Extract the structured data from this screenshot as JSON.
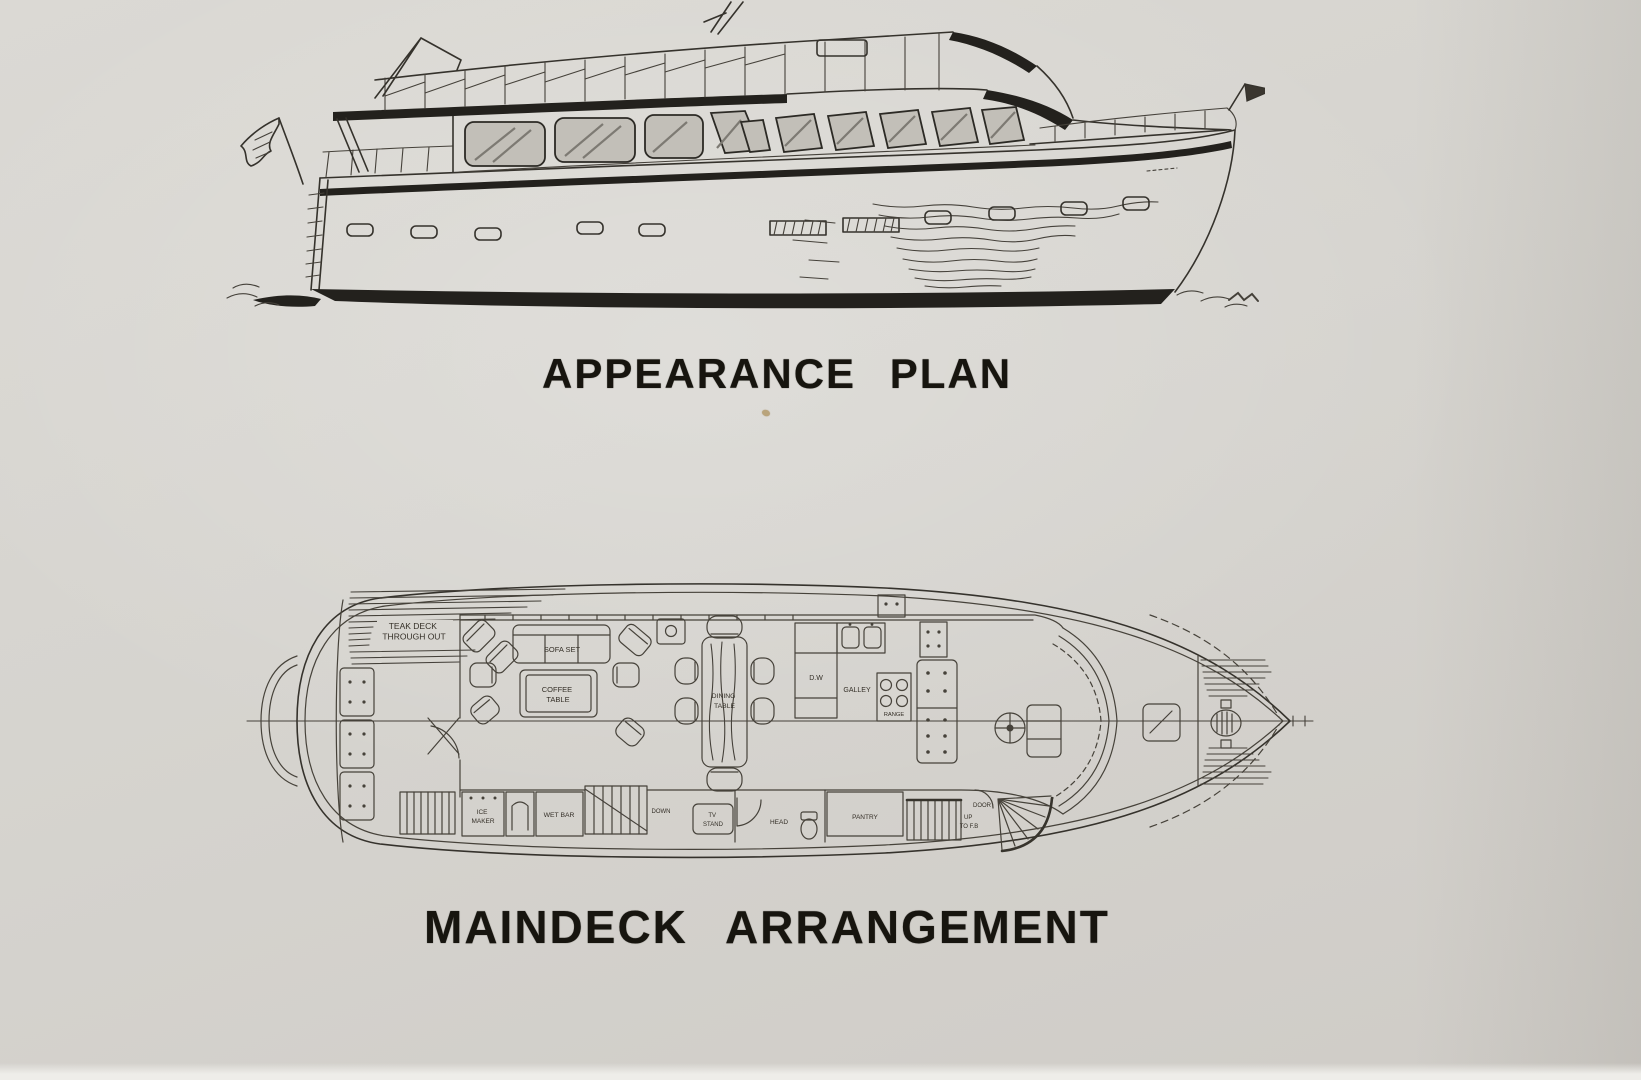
{
  "document": {
    "kind": "scanned yacht brochure page",
    "paper_color": "#d6d4cf",
    "ink_color": "#35322c"
  },
  "titles": {
    "appearance_plan": "APPEARANCE PLAN",
    "maindeck_arrangement": "MAINDECK ARRANGEMENT"
  },
  "appearance_plan": {
    "drawing": "motor yacht side-profile line drawing",
    "feature_icons": [
      "stern-flag-icon",
      "transom-ladder-icon",
      "davit-mast-icon",
      "antenna-mast-icon",
      "flybridge-railing-icon",
      "salon-windows-icon",
      "pilothouse-windows-icon",
      "bow-railing-icon",
      "bow-flag-icon",
      "porthole-icon",
      "engine-vent-icon",
      "waterline-ripples-icon"
    ]
  },
  "deck_plan": {
    "drawing": "maindeck top-view arrangement plan",
    "labels": {
      "teak_deck_line1": "TEAK DECK",
      "teak_deck_line2": "THROUGH OUT",
      "sofa_set": "SOFA SET",
      "coffee_table_line1": "COFFEE",
      "coffee_table_line2": "TABLE",
      "dining_table_line1": "DINING",
      "dining_table_line2": "TABLE",
      "dishwasher": "D.W",
      "galley": "GALLEY",
      "range": "RANGE",
      "ice_maker_line1": "ICE",
      "ice_maker_line2": "MAKER",
      "wet_bar": "WET BAR",
      "stairs_down": "DOWN",
      "tv_stand_line1": "TV",
      "tv_stand_line2": "STAND",
      "head": "HEAD",
      "pantry": "PANTRY",
      "door": "DOOR",
      "stairs_up_line1": "UP",
      "stairs_up_line2": "TO F.B"
    }
  }
}
